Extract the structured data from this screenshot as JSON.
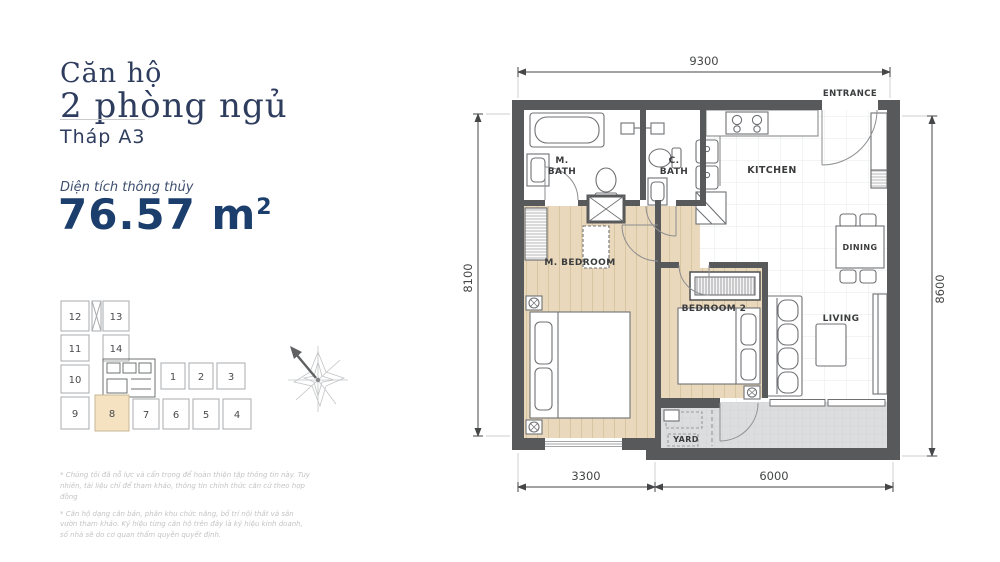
{
  "info_panel": {
    "title_line1": "Căn hộ",
    "title_line2": "2 phòng ngủ",
    "tower_label": "Tháp A3",
    "area_label": "Diện tích thông thủy",
    "area_value": "76.57",
    "area_unit": " m",
    "area_exponent": "2",
    "footnote_1": "* Chúng tôi đã nỗ lực và cẩn trọng để hoàn thiện tập thông tin này. Tuy nhiên, tài liệu chỉ để tham khảo, thông tin chính thức căn cứ theo hợp đồng",
    "footnote_2": "* Căn hộ dạng căn bản, phân khu chức năng, bố trí nội thất và sân vườn tham khảo. Ký hiệu từng căn hộ trên đây là ký hiệu kinh doanh, số nhà sẽ do cơ quan thẩm quyền quyết định."
  },
  "key_plan": {
    "highlighted_unit": "8",
    "units": [
      "1",
      "2",
      "3",
      "4",
      "5",
      "6",
      "7",
      "8",
      "9",
      "10",
      "11",
      "12",
      "13",
      "14"
    ]
  },
  "floor_plan": {
    "dimensions": {
      "top": "9300",
      "left": "8100",
      "right": "8600",
      "bottom_left": "3300",
      "bottom_right": "6000"
    },
    "rooms": {
      "entrance": "ENTRANCE",
      "m_bath_line1": "M.",
      "m_bath_line2": "BATH",
      "c_bath_line1": "C.",
      "c_bath_line2": "BATH",
      "kitchen": "KITCHEN",
      "dining": "DINING",
      "m_bedroom": "M. BEDROOM",
      "bedroom_2": "BEDROOM 2",
      "living": "LIVING",
      "yard": "YARD"
    }
  },
  "colors": {
    "navy_heading": "#2e3d5e",
    "navy_accent": "#1c3e6d",
    "wall": "#58595b",
    "wood_floor": "#e9d8bb",
    "balcony_gray": "#dcddde",
    "highlight_unit": "#f4e2c0"
  }
}
